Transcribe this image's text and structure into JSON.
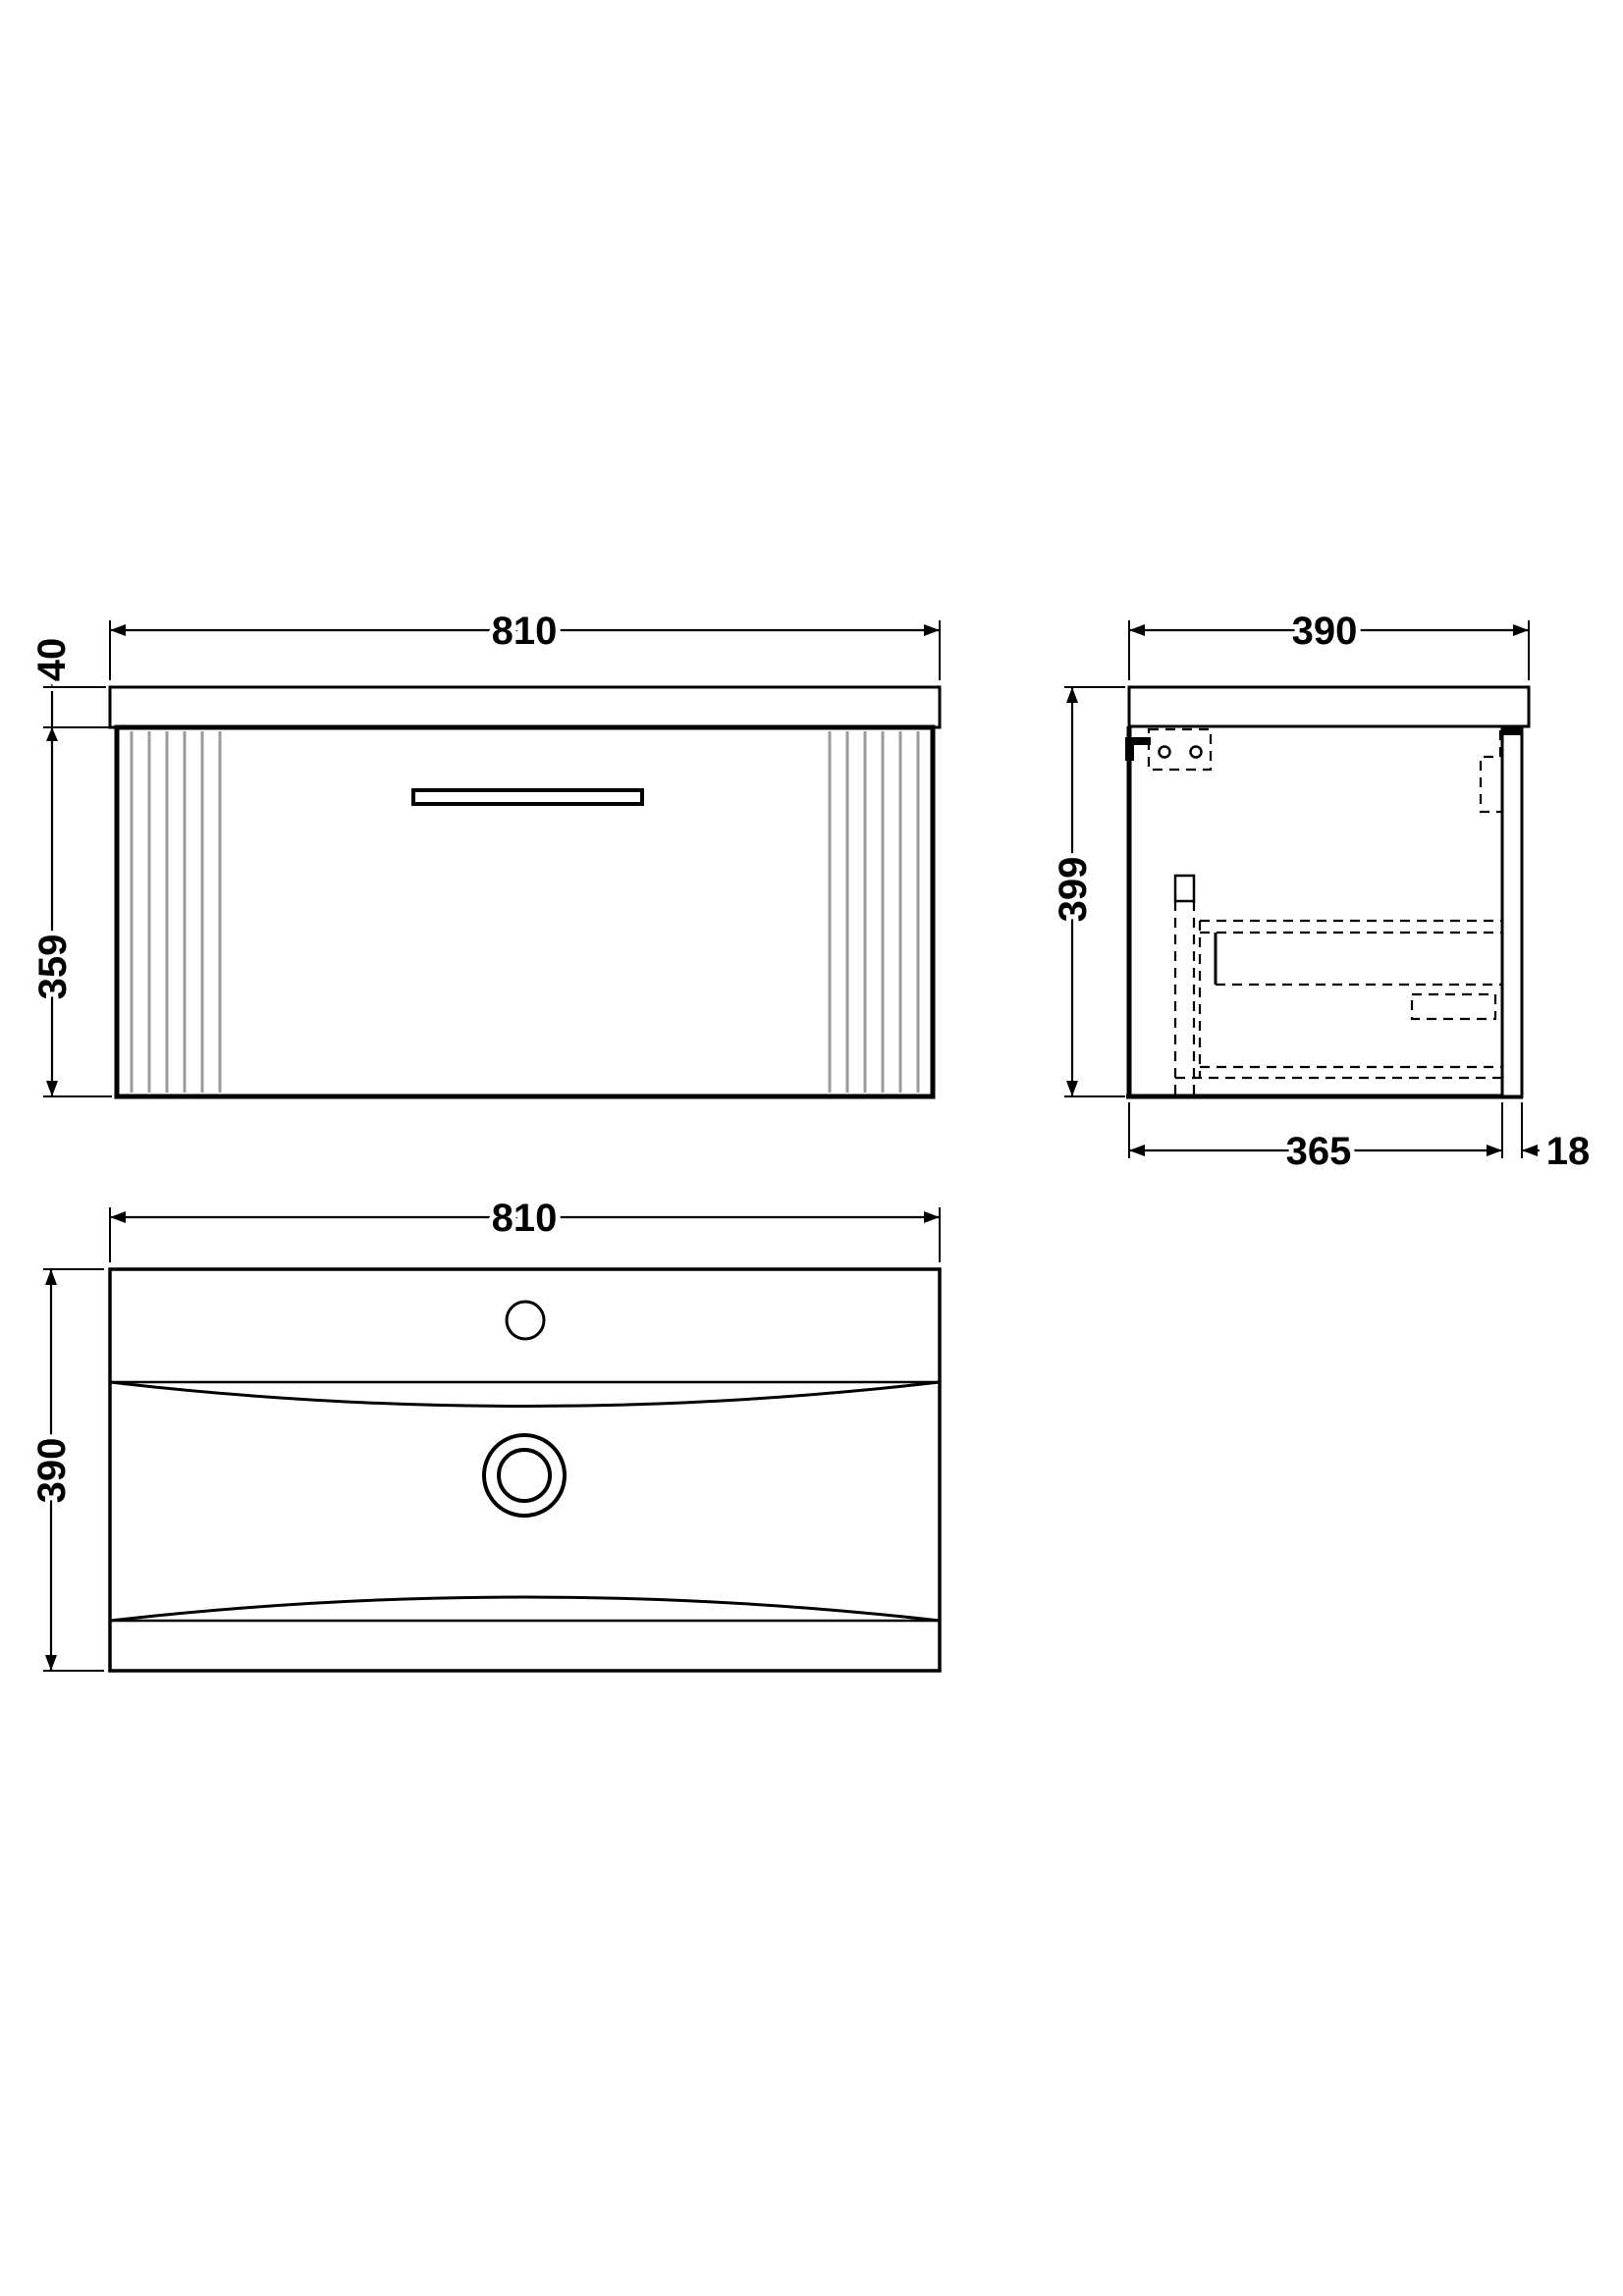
{
  "colors": {
    "line": "#000000",
    "flute_line": "#9b9b9b",
    "background": "#ffffff"
  },
  "dims": {
    "front": {
      "width": "810",
      "worktop_thickness": "40",
      "cabinet_height": "359"
    },
    "side": {
      "depth": "390",
      "overall_height": "399",
      "cabinet_depth": "365",
      "door_thickness": "18"
    },
    "plan": {
      "width": "810",
      "depth": "390"
    }
  }
}
